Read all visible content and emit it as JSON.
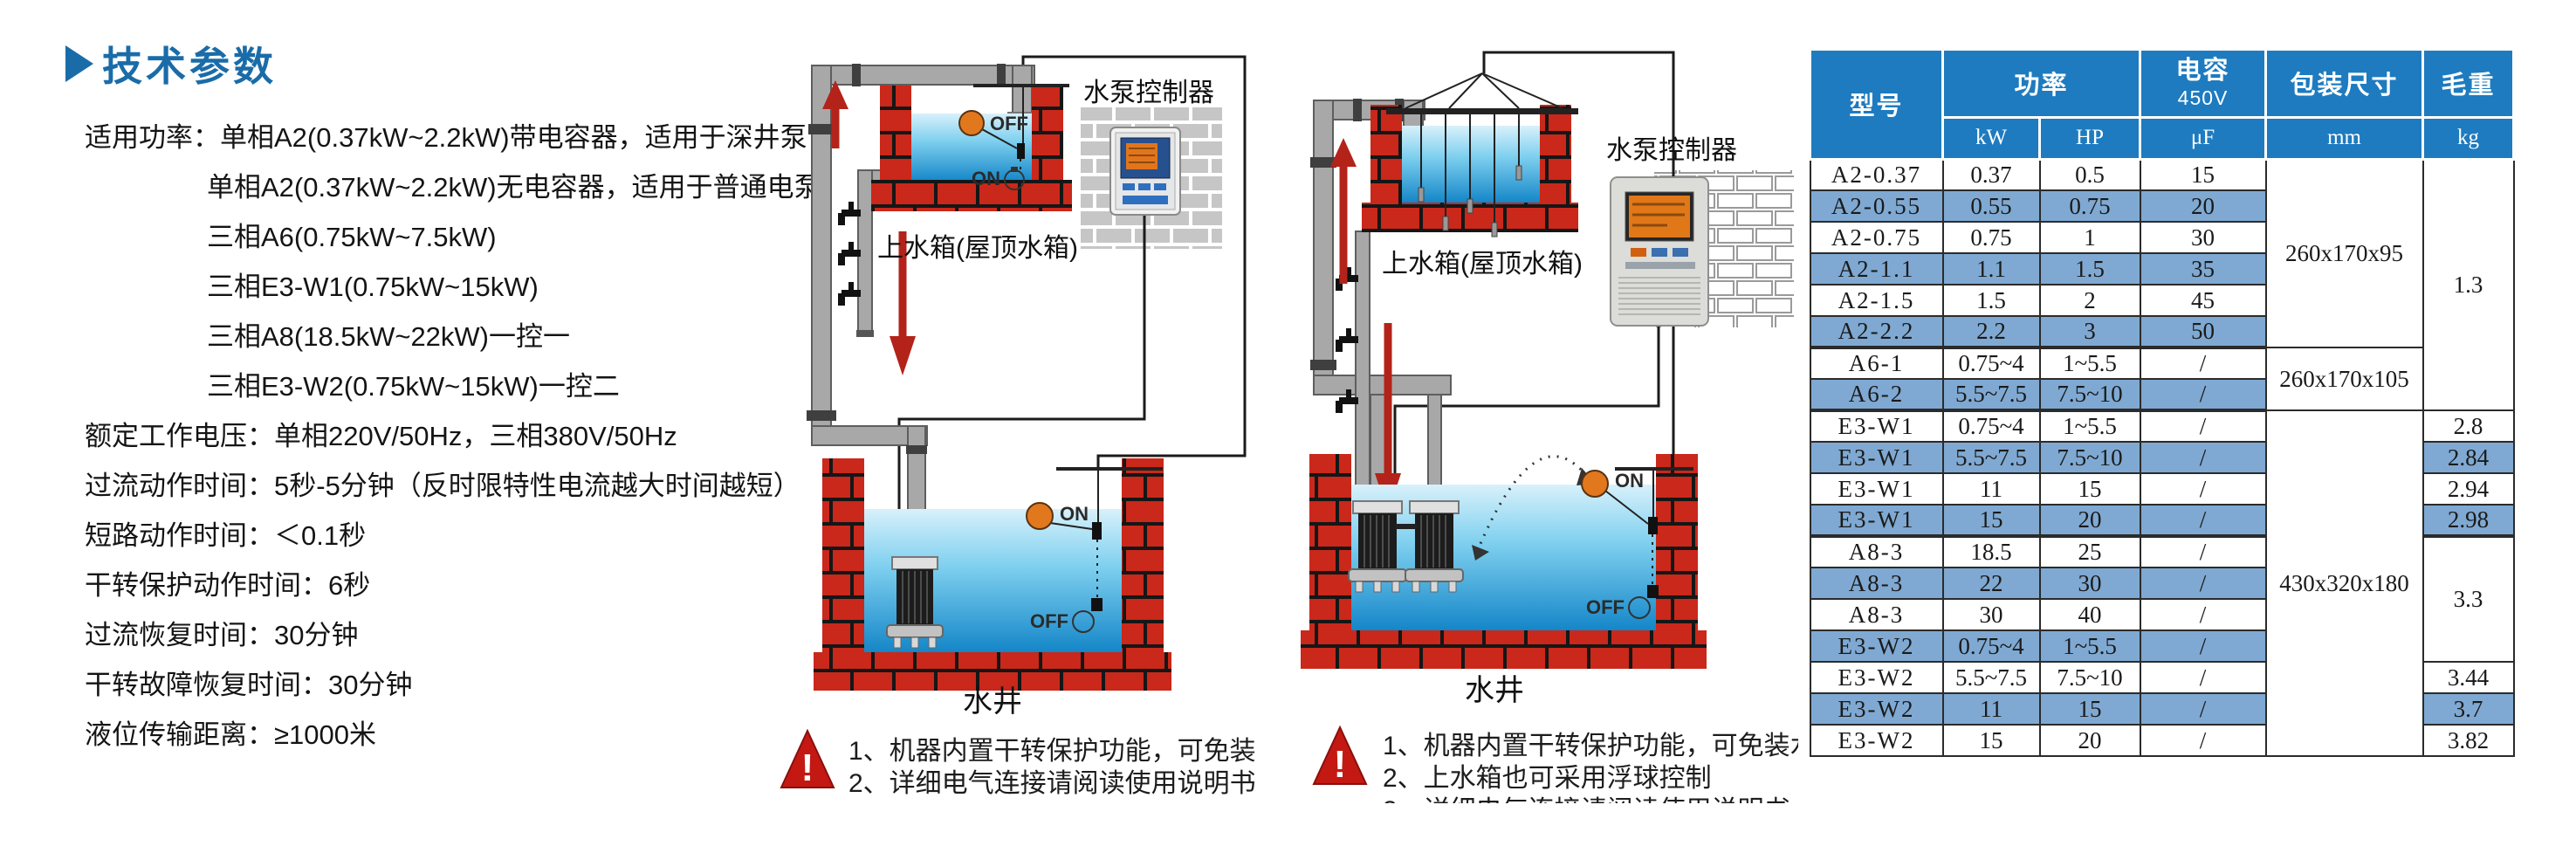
{
  "heading": {
    "title": "技术参数"
  },
  "specs": {
    "lines": [
      {
        "text": "适用功率：单相A2(0.37kW~2.2kW)带电容器，适用于深井泵"
      },
      {
        "text": "单相A2(0.37kW~2.2kW)无电容器，适用于普通电泵"
      },
      {
        "text": "三相A6(0.75kW~7.5kW)"
      },
      {
        "text": "三相E3-W1(0.75kW~15kW)"
      },
      {
        "text": "三相A8(18.5kW~22kW)一控一"
      },
      {
        "text": "三相E3-W2(0.75kW~15kW)一控二"
      },
      {
        "text": "额定工作电压：单相220V/50Hz，三相380V/50Hz"
      },
      {
        "text": "过流动作时间：5秒-5分钟（反时限特性电流越大时间越短）"
      },
      {
        "text": "短路动作时间：＜0.1秒"
      },
      {
        "text": "干转保护动作时间：6秒"
      },
      {
        "text": "过流恢复时间：30分钟"
      },
      {
        "text": "干转故障恢复时间：30分钟"
      },
      {
        "text": "液位传输距离：≥1000米"
      }
    ]
  },
  "diagram1": {
    "controller_label": "水泵控制器",
    "tank_label": "上水箱(屋顶水箱)",
    "well_label": "水井",
    "tank_float": {
      "off": "OFF",
      "on": "ON"
    },
    "well_float": {
      "on": "ON",
      "off": "OFF"
    },
    "warning_mark": "!",
    "notes": [
      "1、机器内置干转保护功能，可免装水井探头/浮球",
      "2、详细电气连接请阅读使用说明书"
    ]
  },
  "diagram2": {
    "controller_label": "水泵控制器",
    "tank_label": "上水箱(屋顶水箱)",
    "well_label": "水井",
    "well_float": {
      "on": "ON",
      "off": "OFF"
    },
    "warning_mark": "!",
    "notes": [
      "1、机器内置干转保护功能，可免装水井浮球",
      "2、上水箱也可采用浮球控制",
      "3、详细电气连接请阅读使用说明书"
    ]
  },
  "table": {
    "header": {
      "model": "型号",
      "power": "功率",
      "kw": "kW",
      "hp": "HP",
      "cap_line1": "电容",
      "cap_line2": "450V",
      "uf": "μF",
      "size": "包装尺寸",
      "mm": "mm",
      "weight": "毛重",
      "kg": "kg"
    },
    "rows": [
      {
        "model": "A2-0.37",
        "kw": "0.37",
        "hp": "0.5",
        "uf": "15"
      },
      {
        "model": "A2-0.55",
        "kw": "0.55",
        "hp": "0.75",
        "uf": "20"
      },
      {
        "model": "A2-0.75",
        "kw": "0.75",
        "hp": "1",
        "uf": "30"
      },
      {
        "model": "A2-1.1",
        "kw": "1.1",
        "hp": "1.5",
        "uf": "35"
      },
      {
        "model": "A2-1.5",
        "kw": "1.5",
        "hp": "2",
        "uf": "45"
      },
      {
        "model": "A2-2.2",
        "kw": "2.2",
        "hp": "3",
        "uf": "50"
      },
      {
        "model": "A6-1",
        "kw": "0.75~4",
        "hp": "1~5.5",
        "uf": "/"
      },
      {
        "model": "A6-2",
        "kw": "5.5~7.5",
        "hp": "7.5~10",
        "uf": "/"
      },
      {
        "model": "E3-W1",
        "kw": "0.75~4",
        "hp": "1~5.5",
        "uf": "/",
        "weight": "2.8"
      },
      {
        "model": "E3-W1",
        "kw": "5.5~7.5",
        "hp": "7.5~10",
        "uf": "/",
        "weight": "2.84"
      },
      {
        "model": "E3-W1",
        "kw": "11",
        "hp": "15",
        "uf": "/",
        "weight": "2.94"
      },
      {
        "model": "E3-W1",
        "kw": "15",
        "hp": "20",
        "uf": "/",
        "weight": "2.98"
      },
      {
        "model": "A8-3",
        "kw": "18.5",
        "hp": "25",
        "uf": "/"
      },
      {
        "model": "A8-3",
        "kw": "22",
        "hp": "30",
        "uf": "/"
      },
      {
        "model": "A8-3",
        "kw": "30",
        "hp": "40",
        "uf": "/"
      },
      {
        "model": "E3-W2",
        "kw": "0.75~4",
        "hp": "1~5.5",
        "uf": "/"
      },
      {
        "model": "E3-W2",
        "kw": "5.5~7.5",
        "hp": "7.5~10",
        "uf": "/",
        "weight": "3.44"
      },
      {
        "model": "E3-W2",
        "kw": "11",
        "hp": "15",
        "uf": "/",
        "weight": "3.7"
      },
      {
        "model": "E3-W2",
        "kw": "15",
        "hp": "20",
        "uf": "/",
        "weight": "3.82"
      }
    ],
    "merged": {
      "size_a2": "260x170x95",
      "size_a6": "260x170x105",
      "size_large": "430x320x180",
      "weight_a2_a6": "1.3",
      "weight_a8": "3.3"
    }
  },
  "colors": {
    "heading_blue": "#1a6ca8",
    "table_header_blue": "#1e7bbf",
    "table_stripe_blue": "#7fa9d2",
    "brick_red": "#c9281a",
    "water_blue": "#1486c8",
    "arrow_red": "#b3231a",
    "warning_red": "#c31912",
    "float_orange": "#e1781e"
  }
}
